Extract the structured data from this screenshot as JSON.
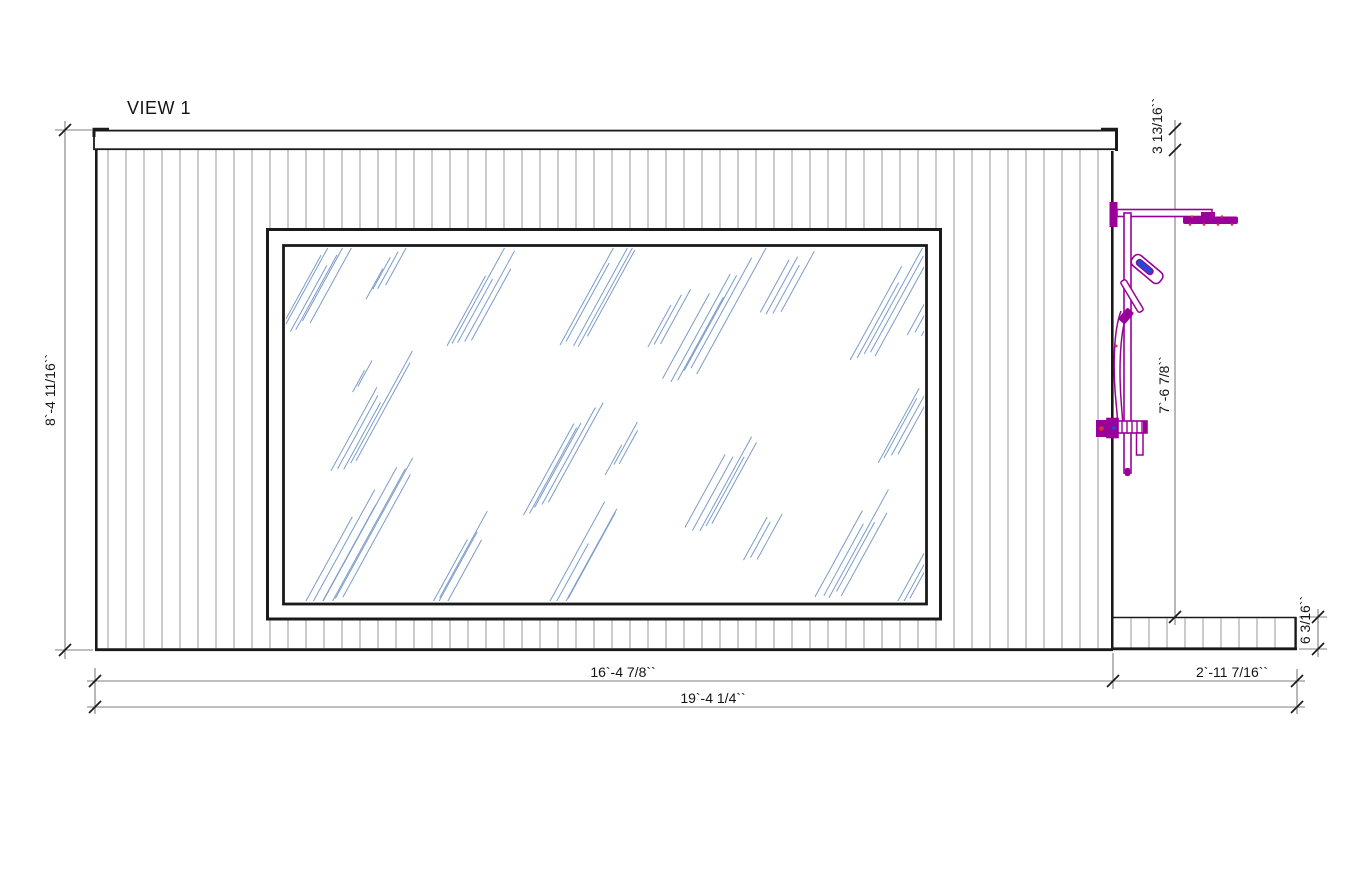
{
  "view": {
    "title": "VIEW 1"
  },
  "dimensions": {
    "wall_height": {
      "label": "8`-4 11/16``"
    },
    "fascia_height": {
      "label": "3 13/16``"
    },
    "shower_height": {
      "label": "7`-6 7/8``"
    },
    "bench_height": {
      "label": "6 3/16``"
    },
    "wall_width": {
      "label": "16`-4 7/8``"
    },
    "bench_width": {
      "label": "2`-11 7/16``"
    },
    "total_width": {
      "label": "19`-4 1/4``"
    }
  },
  "colors": {
    "background": "#ffffff",
    "outline_black": "#1a1a1a",
    "siding_gray": "#9a9a9a",
    "dimension_gray": "#7f7f7f",
    "glass_blue": "#7b9cc9",
    "fixture_purple": "#990099",
    "fixture_accent_blue": "#2a46cf",
    "fixture_accent_red": "#e03030"
  }
}
